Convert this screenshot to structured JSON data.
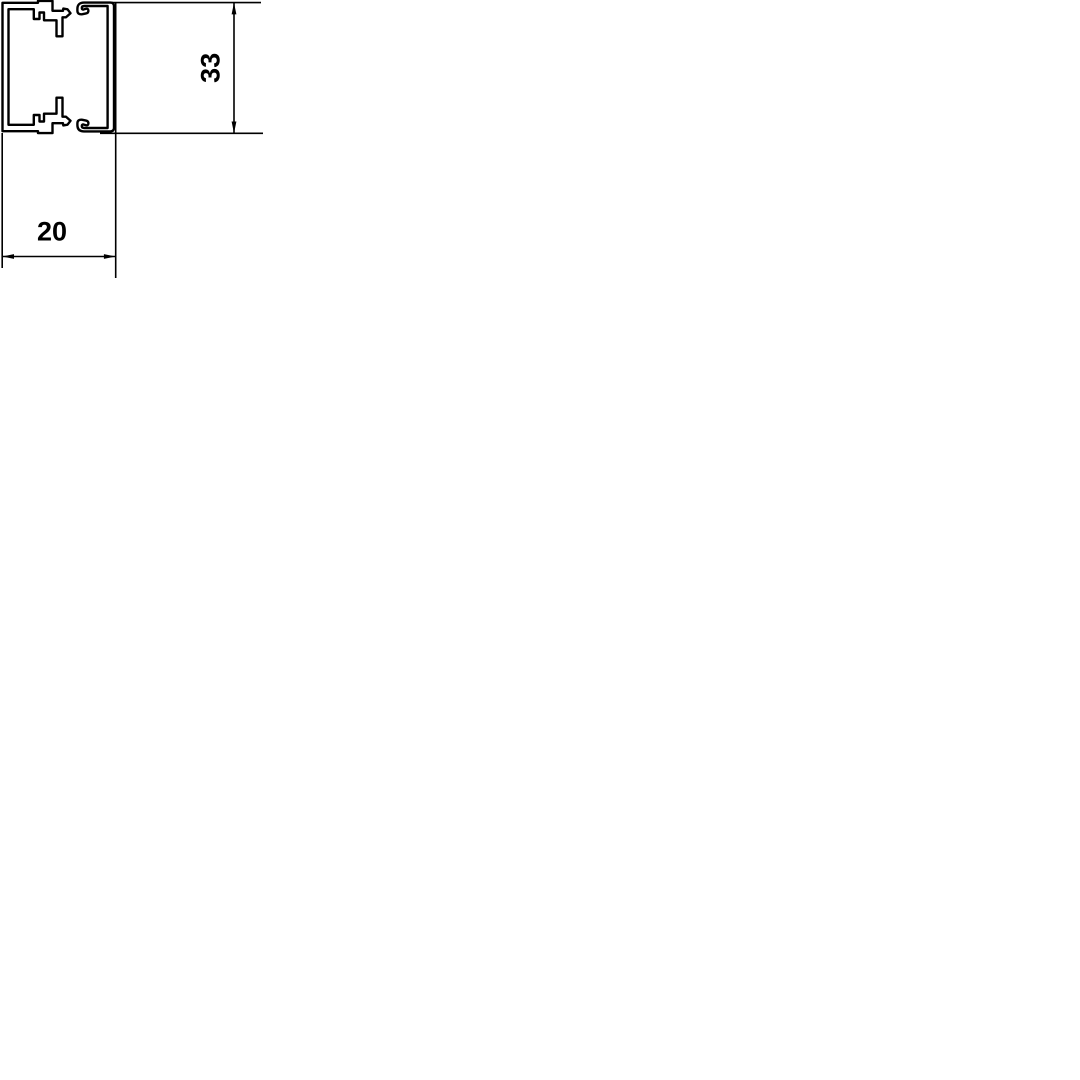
{
  "drawing": {
    "description": "Technical cross-section drawing of a mini cable trunking: U-shaped base channel with two inner snap-clips and a C-shaped snap-on cover, with width and height dimension callouts",
    "dimension_width": {
      "label": "20"
    },
    "dimension_height": {
      "label": "33"
    },
    "colors": {
      "line": "#000000",
      "background": "#ffffff"
    }
  }
}
